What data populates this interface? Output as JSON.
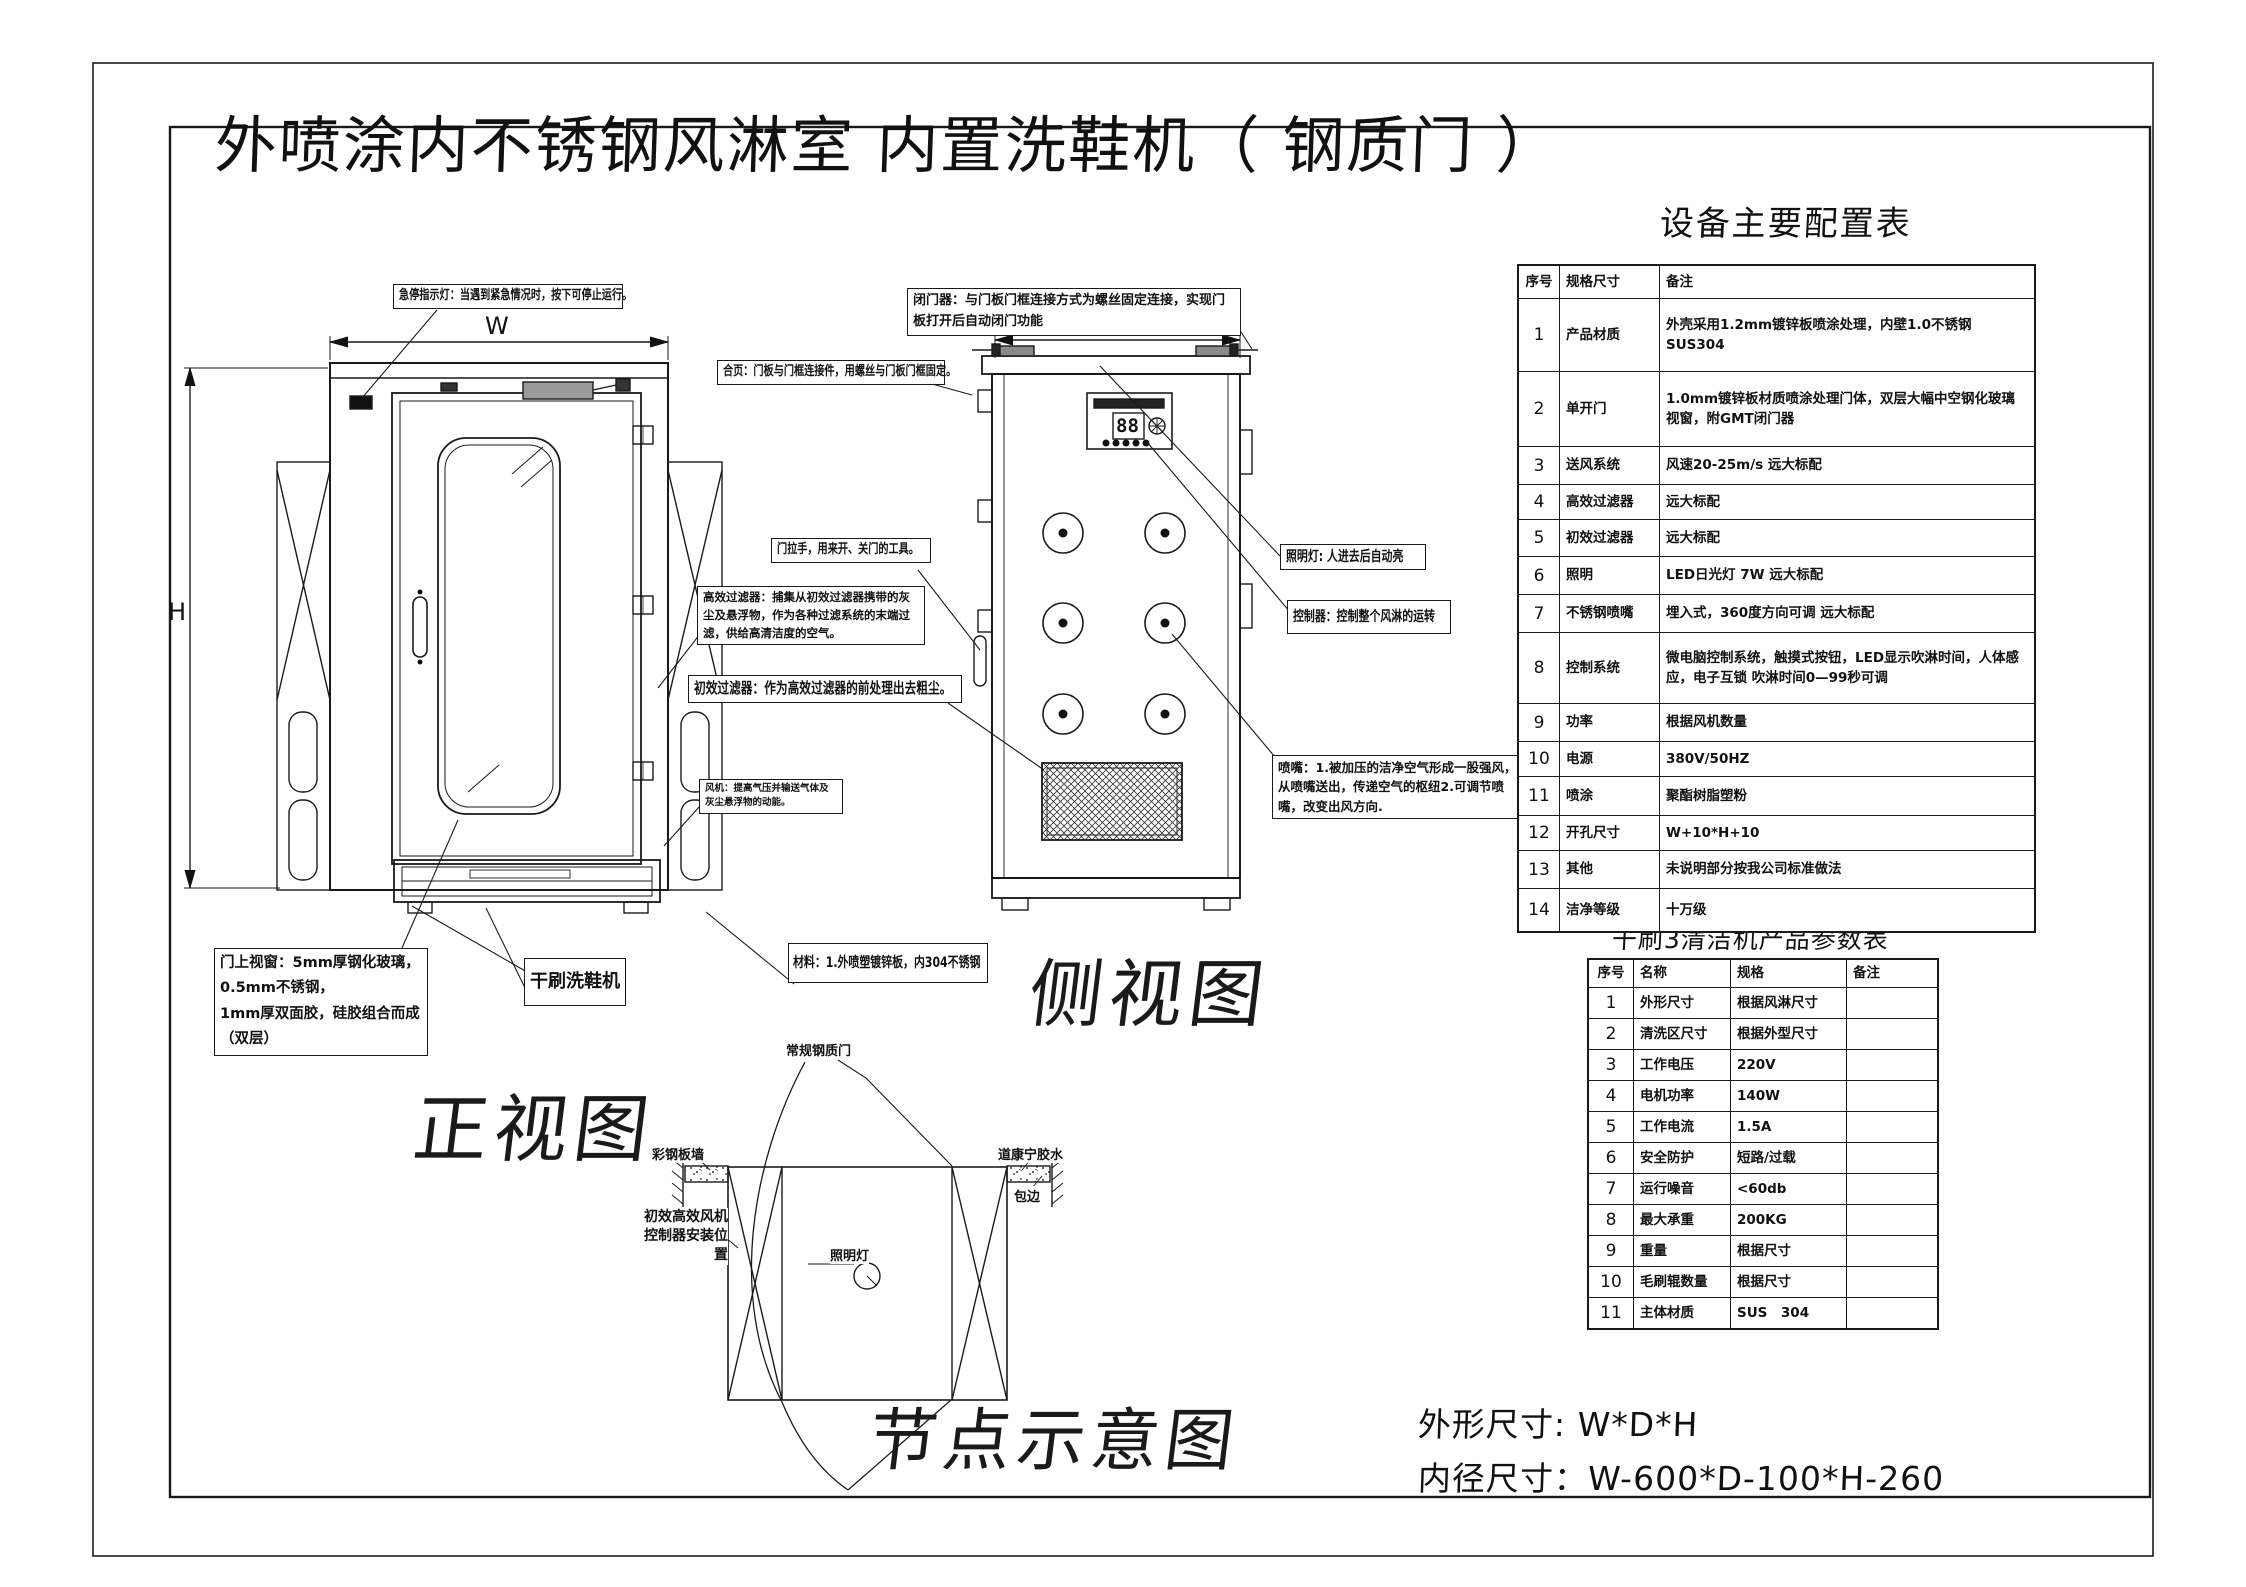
{
  "title": "外喷涂内不锈钢风淋室  内置洗鞋机（ 钢质门 ）",
  "views": {
    "front": "正视图",
    "side": "侧视图",
    "node": "节点示意图"
  },
  "dimensions": {
    "w": "W",
    "h": "H",
    "d": "D"
  },
  "panel": {
    "display": "88"
  },
  "annotations": {
    "estop": "急停指示灯：当遇到紧急情况时，按下可停止运行。",
    "hinge": "合页：门板与门框连接件，用螺丝与门板门框固定。",
    "closer": "闭门器：与门板门框连接方式为螺丝固定连接，实现门板打开后自动闭门功能",
    "handle": "门拉手，用来开、关门的工具。",
    "hepa": "高效过滤器：捕集从初效过滤器携带的灰尘及悬浮物，作为各种过滤系统的末端过滤，供给高清洁度的空气。",
    "prefilter": "初效过滤器：作为高效过滤器的前处理出去粗尘。",
    "fan": "风机：提高气压并输送气体及灰尘悬浮物的动能。",
    "window": "门上视窗：5mm厚钢化玻璃，\n0.5mm不锈钢，\n1mm厚双面胶，硅胶组合而成（双层）",
    "shoe_machine": "干刷洗鞋机",
    "material": "材料：1.外喷塑镀锌板，内304不锈钢",
    "light": "照明灯: 人进去后自动亮",
    "controller": "控制器：控制整个风淋的运转",
    "nozzle": "喷嘴：1.被加压的洁净空气形成一股强风，从喷嘴送出，传递空气的枢纽2.可调节喷嘴，改变出风方向."
  },
  "node_labels": {
    "door": "常规钢质门",
    "wall": "彩钢板墙",
    "glue": "道康宁胶水",
    "edge": "包边",
    "install": "初效高效风机\n控制器安装位\n置",
    "lamp": "照明灯"
  },
  "config_table": {
    "title": "设备主要配置表",
    "headers": [
      "序号",
      "规格尺寸",
      "备注"
    ],
    "rows": [
      {
        "no": "1",
        "spec": "产品材质",
        "note": "外壳采用1.2mm镀锌板喷涂处理，内壁1.0不锈钢SUS304"
      },
      {
        "no": "2",
        "spec": "单开门",
        "note": "1.0mm镀锌板材质喷涂处理门体，双层大幅中空钢化玻璃视窗，附GMT闭门器"
      },
      {
        "no": "3",
        "spec": "送风系统",
        "note": "风速20-25m/s  远大标配"
      },
      {
        "no": "4",
        "spec": "高效过滤器",
        "note": "远大标配"
      },
      {
        "no": "5",
        "spec": "初效过滤器",
        "note": "远大标配"
      },
      {
        "no": "6",
        "spec": "照明",
        "note": "LED日光灯  7W  远大标配"
      },
      {
        "no": "7",
        "spec": "不锈钢喷嘴",
        "note": "埋入式，360度方向可调  远大标配"
      },
      {
        "no": "8",
        "spec": "控制系统",
        "note": "微电脑控制系统，触摸式按钮，LED显示吹淋时间，人体感应，电子互锁 吹淋时间0—99秒可调"
      },
      {
        "no": "9",
        "spec": "功率",
        "note": "根据风机数量"
      },
      {
        "no": "10",
        "spec": "电源",
        "note": "380V/50HZ"
      },
      {
        "no": "11",
        "spec": "喷涂",
        "note": "聚酯树脂塑粉"
      },
      {
        "no": "12",
        "spec": "开孔尺寸",
        "note": "W+10*H+10"
      },
      {
        "no": "13",
        "spec": "其他",
        "note": "未说明部分按我公司标准做法"
      },
      {
        "no": "14",
        "spec": "洁净等级",
        "note": "十万级"
      }
    ]
  },
  "param_table": {
    "title": "干刷3清洁机产品参数表",
    "headers": [
      "序号",
      "名称",
      "规格",
      "备注"
    ],
    "rows": [
      {
        "no": "1",
        "name": "外形尺寸",
        "spec": "根据风淋尺寸",
        "note": ""
      },
      {
        "no": "2",
        "name": "清洗区尺寸",
        "spec": "根据外型尺寸",
        "note": ""
      },
      {
        "no": "3",
        "name": "工作电压",
        "spec": "220V",
        "note": ""
      },
      {
        "no": "4",
        "name": "电机功率",
        "spec": "140W",
        "note": ""
      },
      {
        "no": "5",
        "name": "工作电流",
        "spec": "1.5A",
        "note": ""
      },
      {
        "no": "6",
        "name": "安全防护",
        "spec": "短路/过载",
        "note": ""
      },
      {
        "no": "7",
        "name": "运行噪音",
        "spec": "<60db",
        "note": ""
      },
      {
        "no": "8",
        "name": "最大承重",
        "spec": "200KG",
        "note": ""
      },
      {
        "no": "9",
        "name": "重量",
        "spec": "根据尺寸",
        "note": ""
      },
      {
        "no": "10",
        "name": "毛刷辊数量",
        "spec": "根据尺寸",
        "note": ""
      },
      {
        "no": "11",
        "name": "主体材质",
        "spec": "SUS　304",
        "note": ""
      }
    ]
  },
  "footer": {
    "line1": "外形尺寸: W*D*H",
    "line2": "内径尺寸：W-600*D-100*H-260"
  }
}
